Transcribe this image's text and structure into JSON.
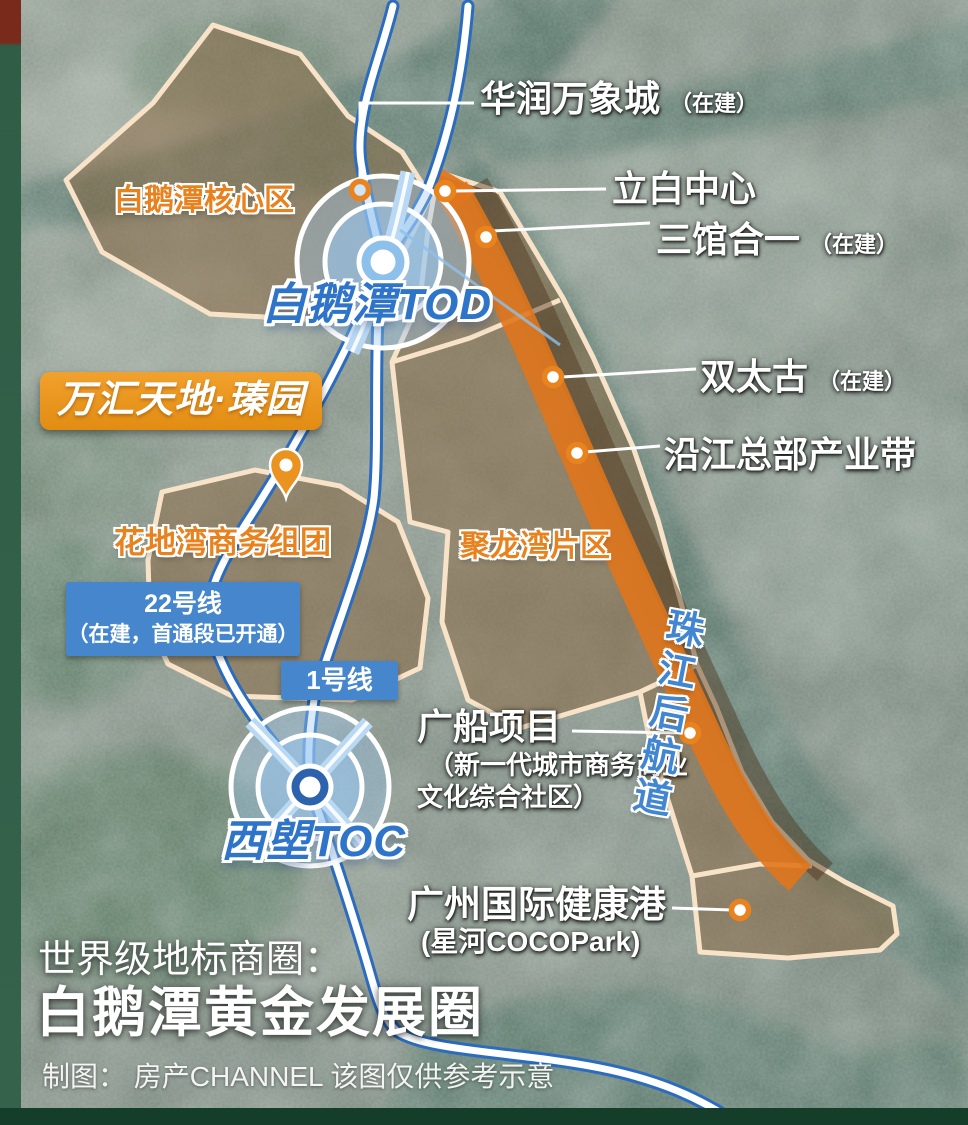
{
  "colors": {
    "accent_orange": "#E8941D",
    "district_label_orange": "#E8821F",
    "riverfront_band_orange": "#E0751C",
    "metro_line_blue": "#2B6CBF",
    "badge_blue": "#4586CD",
    "station_text_blue": "#2E74C8",
    "region_border_cream": "#F8E3C8",
    "frame_green": "#2F5D46"
  },
  "labels": {
    "huarun": {
      "main": "华润万象城",
      "suffix": "（在建）"
    },
    "libai": {
      "main": "立白中心"
    },
    "sanguan": {
      "main": "三馆合一",
      "suffix": "（在建）"
    },
    "core_area": {
      "main": "白鹅潭核心区"
    },
    "tod": {
      "main": "白鹅潭TOD"
    },
    "wanhui": {
      "main": "万汇天地·瑧园"
    },
    "huadiwan": {
      "main": "花地湾商务组团"
    },
    "julongwan": {
      "main": "聚龙湾片区"
    },
    "shuangtaigu": {
      "main": "双太古",
      "suffix": "（在建）"
    },
    "yanjiang": {
      "main": "沿江总部产业带"
    },
    "line22": {
      "line1": "22号线",
      "line2": "（在建，首通段已开通）"
    },
    "line1": {
      "main": "1号线"
    },
    "toc": {
      "main": "西塱TOC"
    },
    "guangchuan": {
      "main": "广船项目",
      "sub1": "（新一代城市商务商业",
      "sub2": "文化综合社区）"
    },
    "zhujiang": {
      "main": "珠江后航道"
    },
    "jiankang": {
      "main": "广州国际健康港",
      "sub": "(星河COCOPark)"
    },
    "title": {
      "line1": "世界级地标商圈：",
      "line2": "白鹅潭黄金发展圈"
    },
    "credit": {
      "main": "制图： 房产CHANNEL 该图仅供参考示意"
    }
  }
}
